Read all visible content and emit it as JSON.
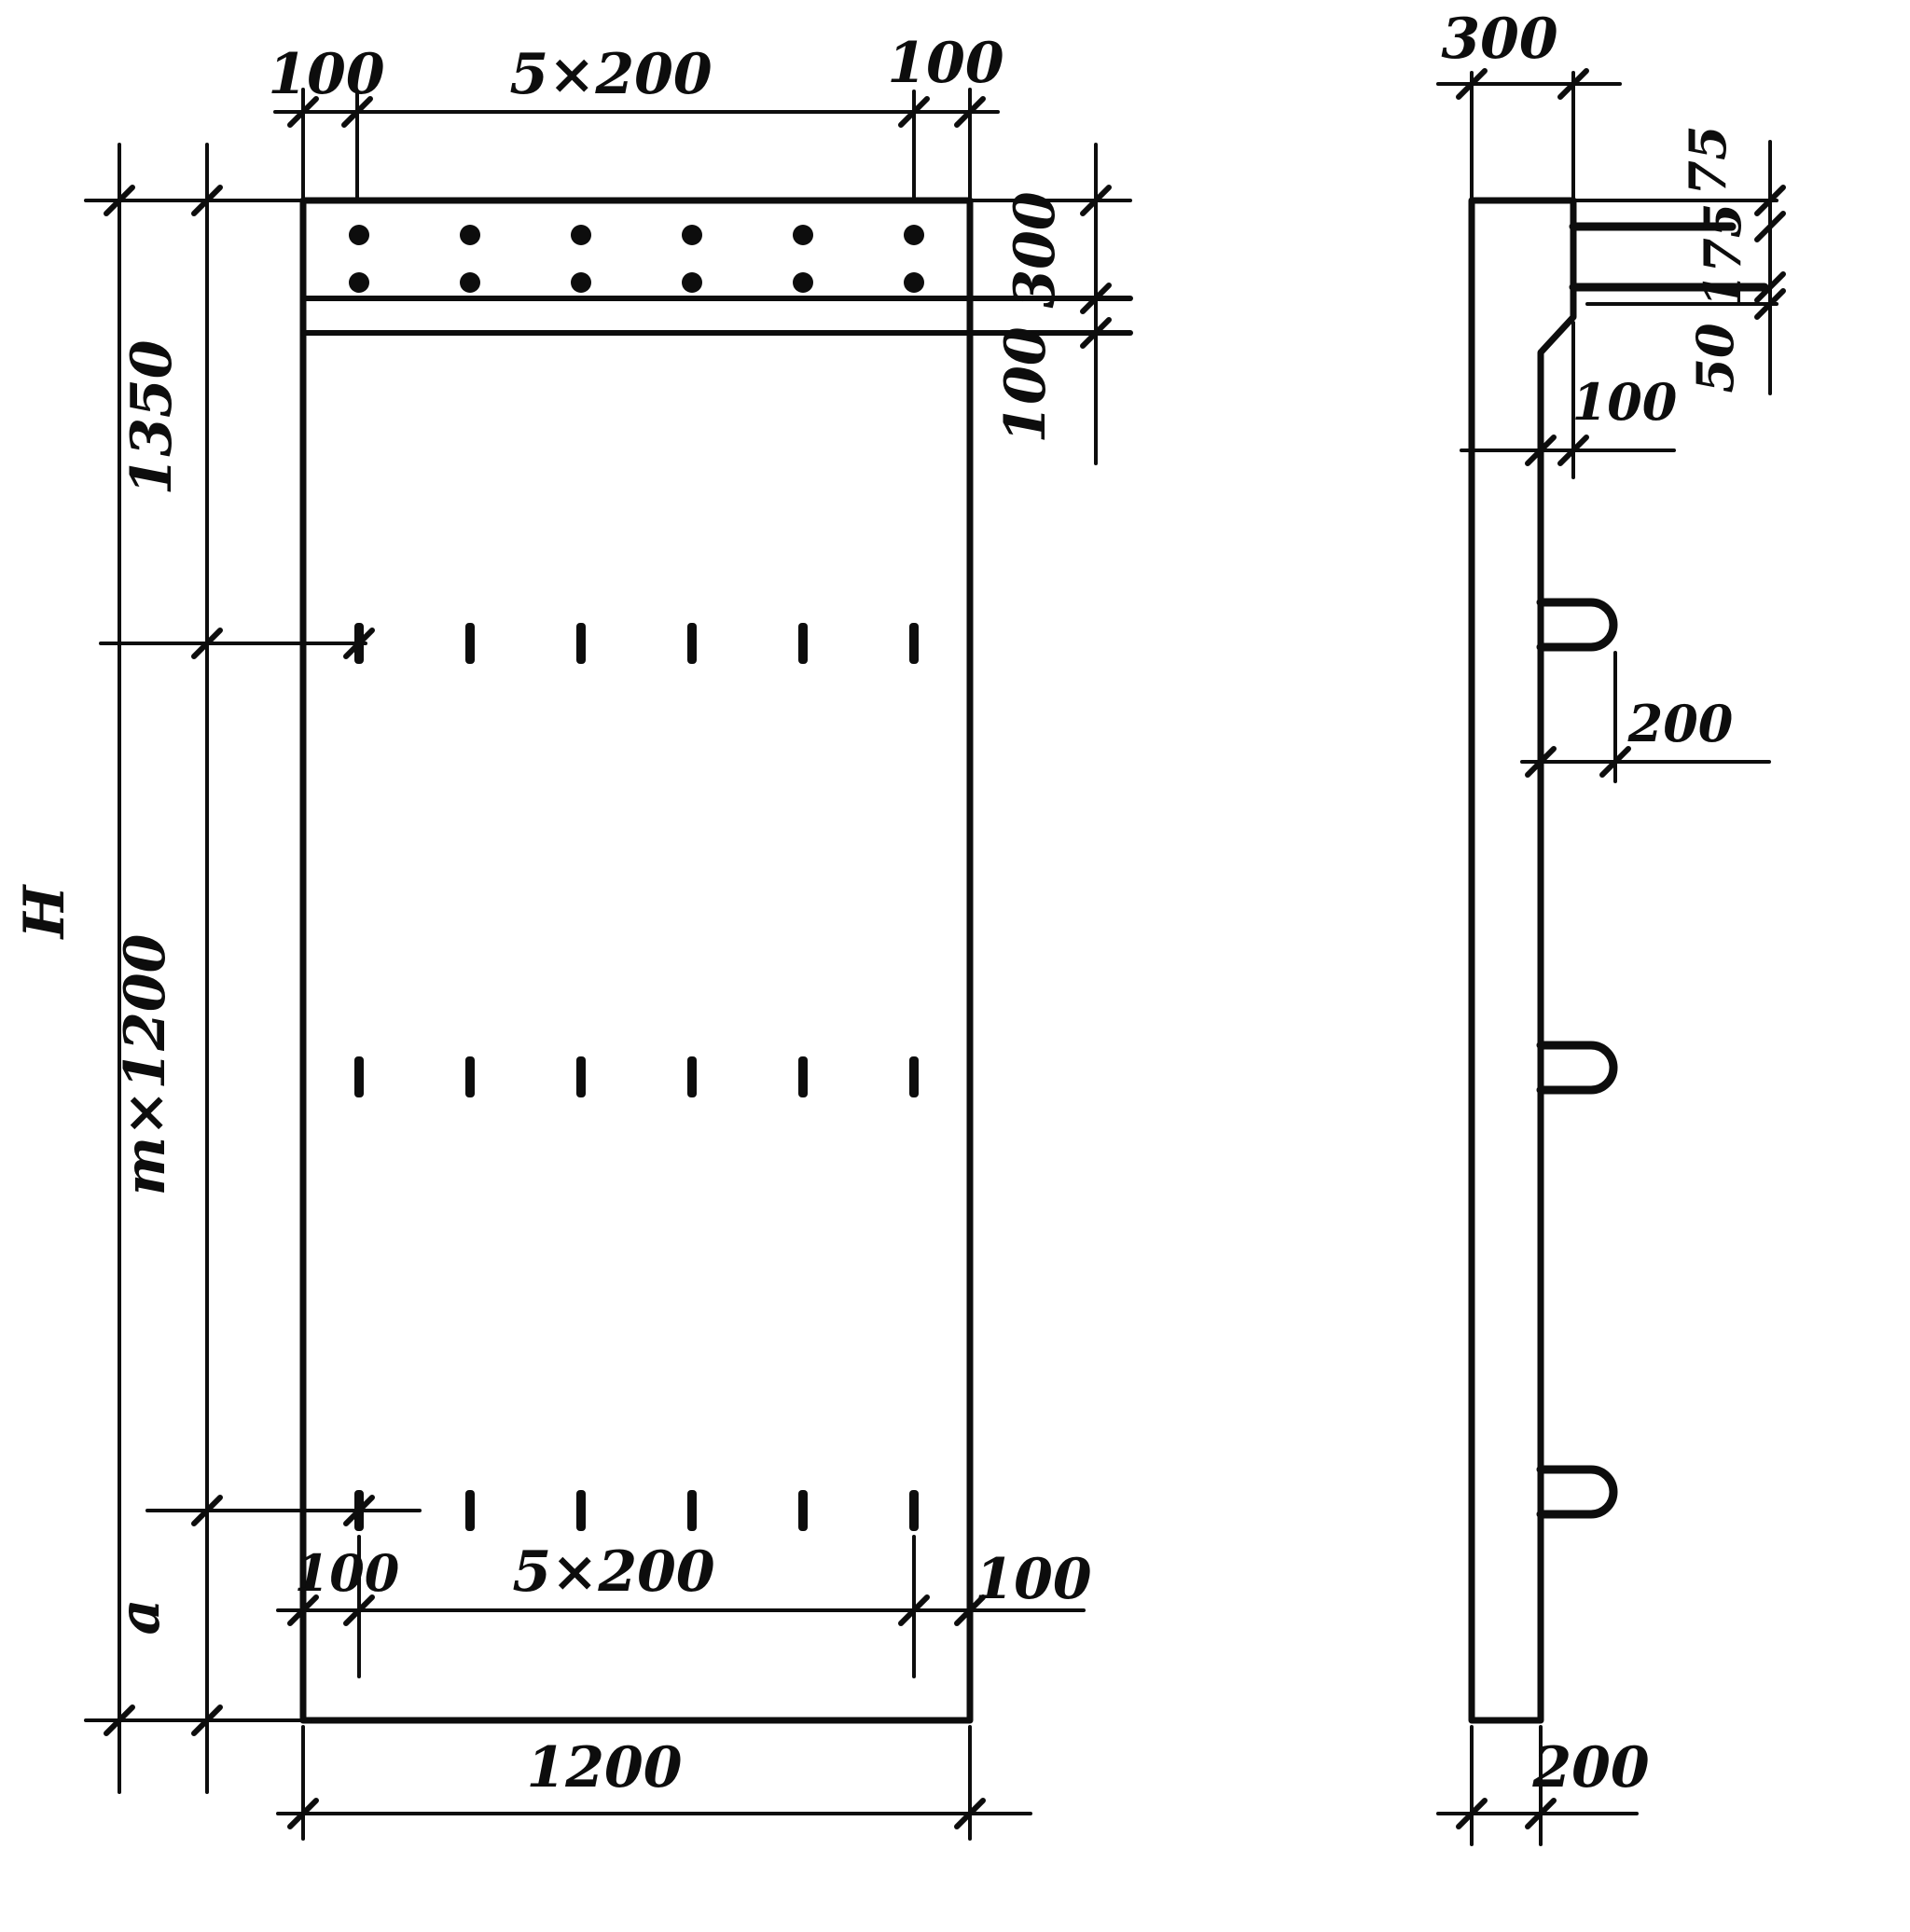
{
  "front_view": {
    "top": {
      "left_margin": "100",
      "hole_spacing": "5×200",
      "right_margin": "100"
    },
    "right": {
      "band_height": "300",
      "band_gap": "100"
    },
    "left": {
      "top_offset": "1350",
      "repeat_height": "m×1200",
      "bottom_offset": "a",
      "total_height": "H"
    },
    "bottom": {
      "left_margin": "100",
      "slot_spacing": "5×200",
      "right_margin": "100",
      "panel_width": "1200"
    }
  },
  "side_view": {
    "top": {
      "panel_thickness": "300"
    },
    "right": {
      "bar_offset_top": "75",
      "bar_spacing": "175",
      "bar_offset_bottom": "50"
    },
    "step_width": "100",
    "loop_protrusion": "200",
    "bottom_thickness": "200"
  }
}
